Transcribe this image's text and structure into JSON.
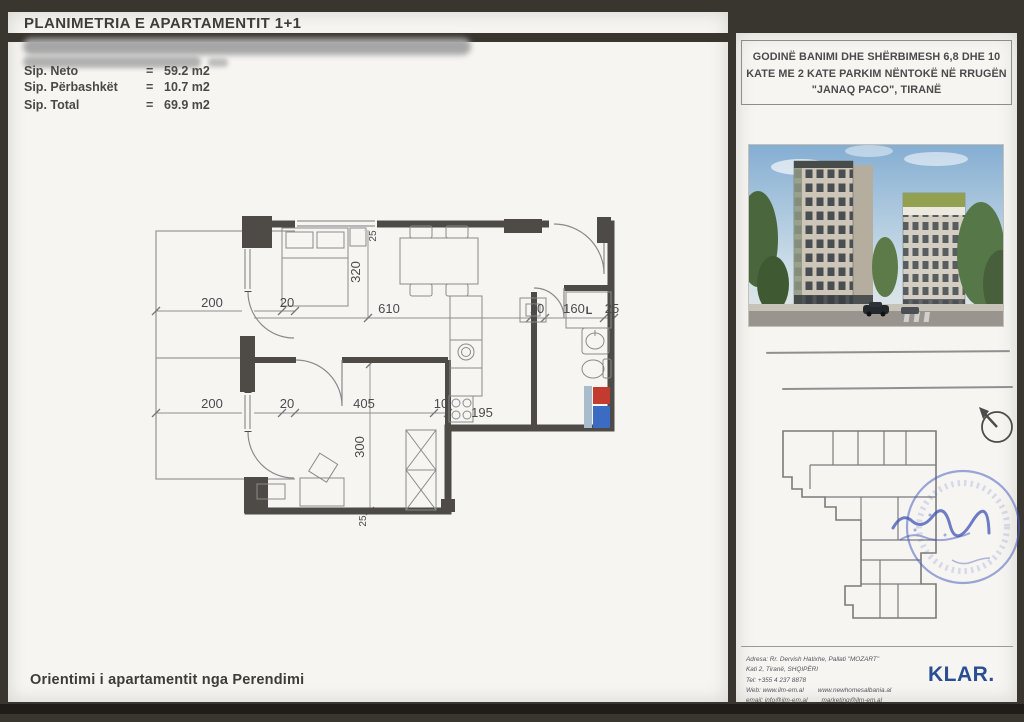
{
  "page": {
    "title": "PLANIMETRIA E APARTAMENTIT 1+1",
    "orientation_note": "Orientimi i apartamentit nga Perendimi"
  },
  "areas": {
    "rows": [
      {
        "label": "Sip. Neto",
        "eq": "=",
        "value": "59.2 m2"
      },
      {
        "label": "Sip. Përbashkët",
        "eq": "=",
        "value": "10.7 m2"
      },
      {
        "label": "Sip. Total",
        "eq": "=",
        "value": "69.9 m2"
      }
    ]
  },
  "floor_plan": {
    "dim_balcony_top_width": "200",
    "dim_balcony_top_wall": "20",
    "dim_living_width": "610",
    "dim_living_height": "320",
    "dim_hall_10": "10",
    "dim_hall_160": "160",
    "dim_hall_25": "25",
    "dim_balcony_bottom_width": "200",
    "dim_balcony_bottom_wall": "20",
    "dim_bedroom_width": "405",
    "dim_bedroom_10": "10",
    "dim_bedroom_height": "300",
    "dim_kitchen_195": "195",
    "dim_wall_top_25": "25",
    "dim_wall_bottom_25": "25",
    "laundry_label": "L"
  },
  "building_header": {
    "line1": "GODINË BANIMI DHE SHËRBIMESH 6,8 DHE 10",
    "line2": "KATE ME 2 KATE PARKIM NËNTOKË NË RRUGËN",
    "line3": "\"JANAQ PACO\", TIRANË"
  },
  "address": {
    "line1": "Adresa: Rr. Dervish Hatixhe, Pallati \"MOZART\"",
    "line2": "Kati 2, Tiranë, SHQIPËRI",
    "line3": "Tel: +355 4 237 8878",
    "web_label": "Web: www.ilm-em.al",
    "web_alt": "www.newhomesalbania.al",
    "email_label": "email: info@ilm-em.al",
    "email_alt": "marketing@ilm-em.al"
  },
  "logo": "KLAR.",
  "colors": {
    "logo_blue": "#2b4d92",
    "stamp_blue": "#4d60bf",
    "riser_red": "#c23b2e",
    "riser_blue": "#3b6bc2"
  }
}
